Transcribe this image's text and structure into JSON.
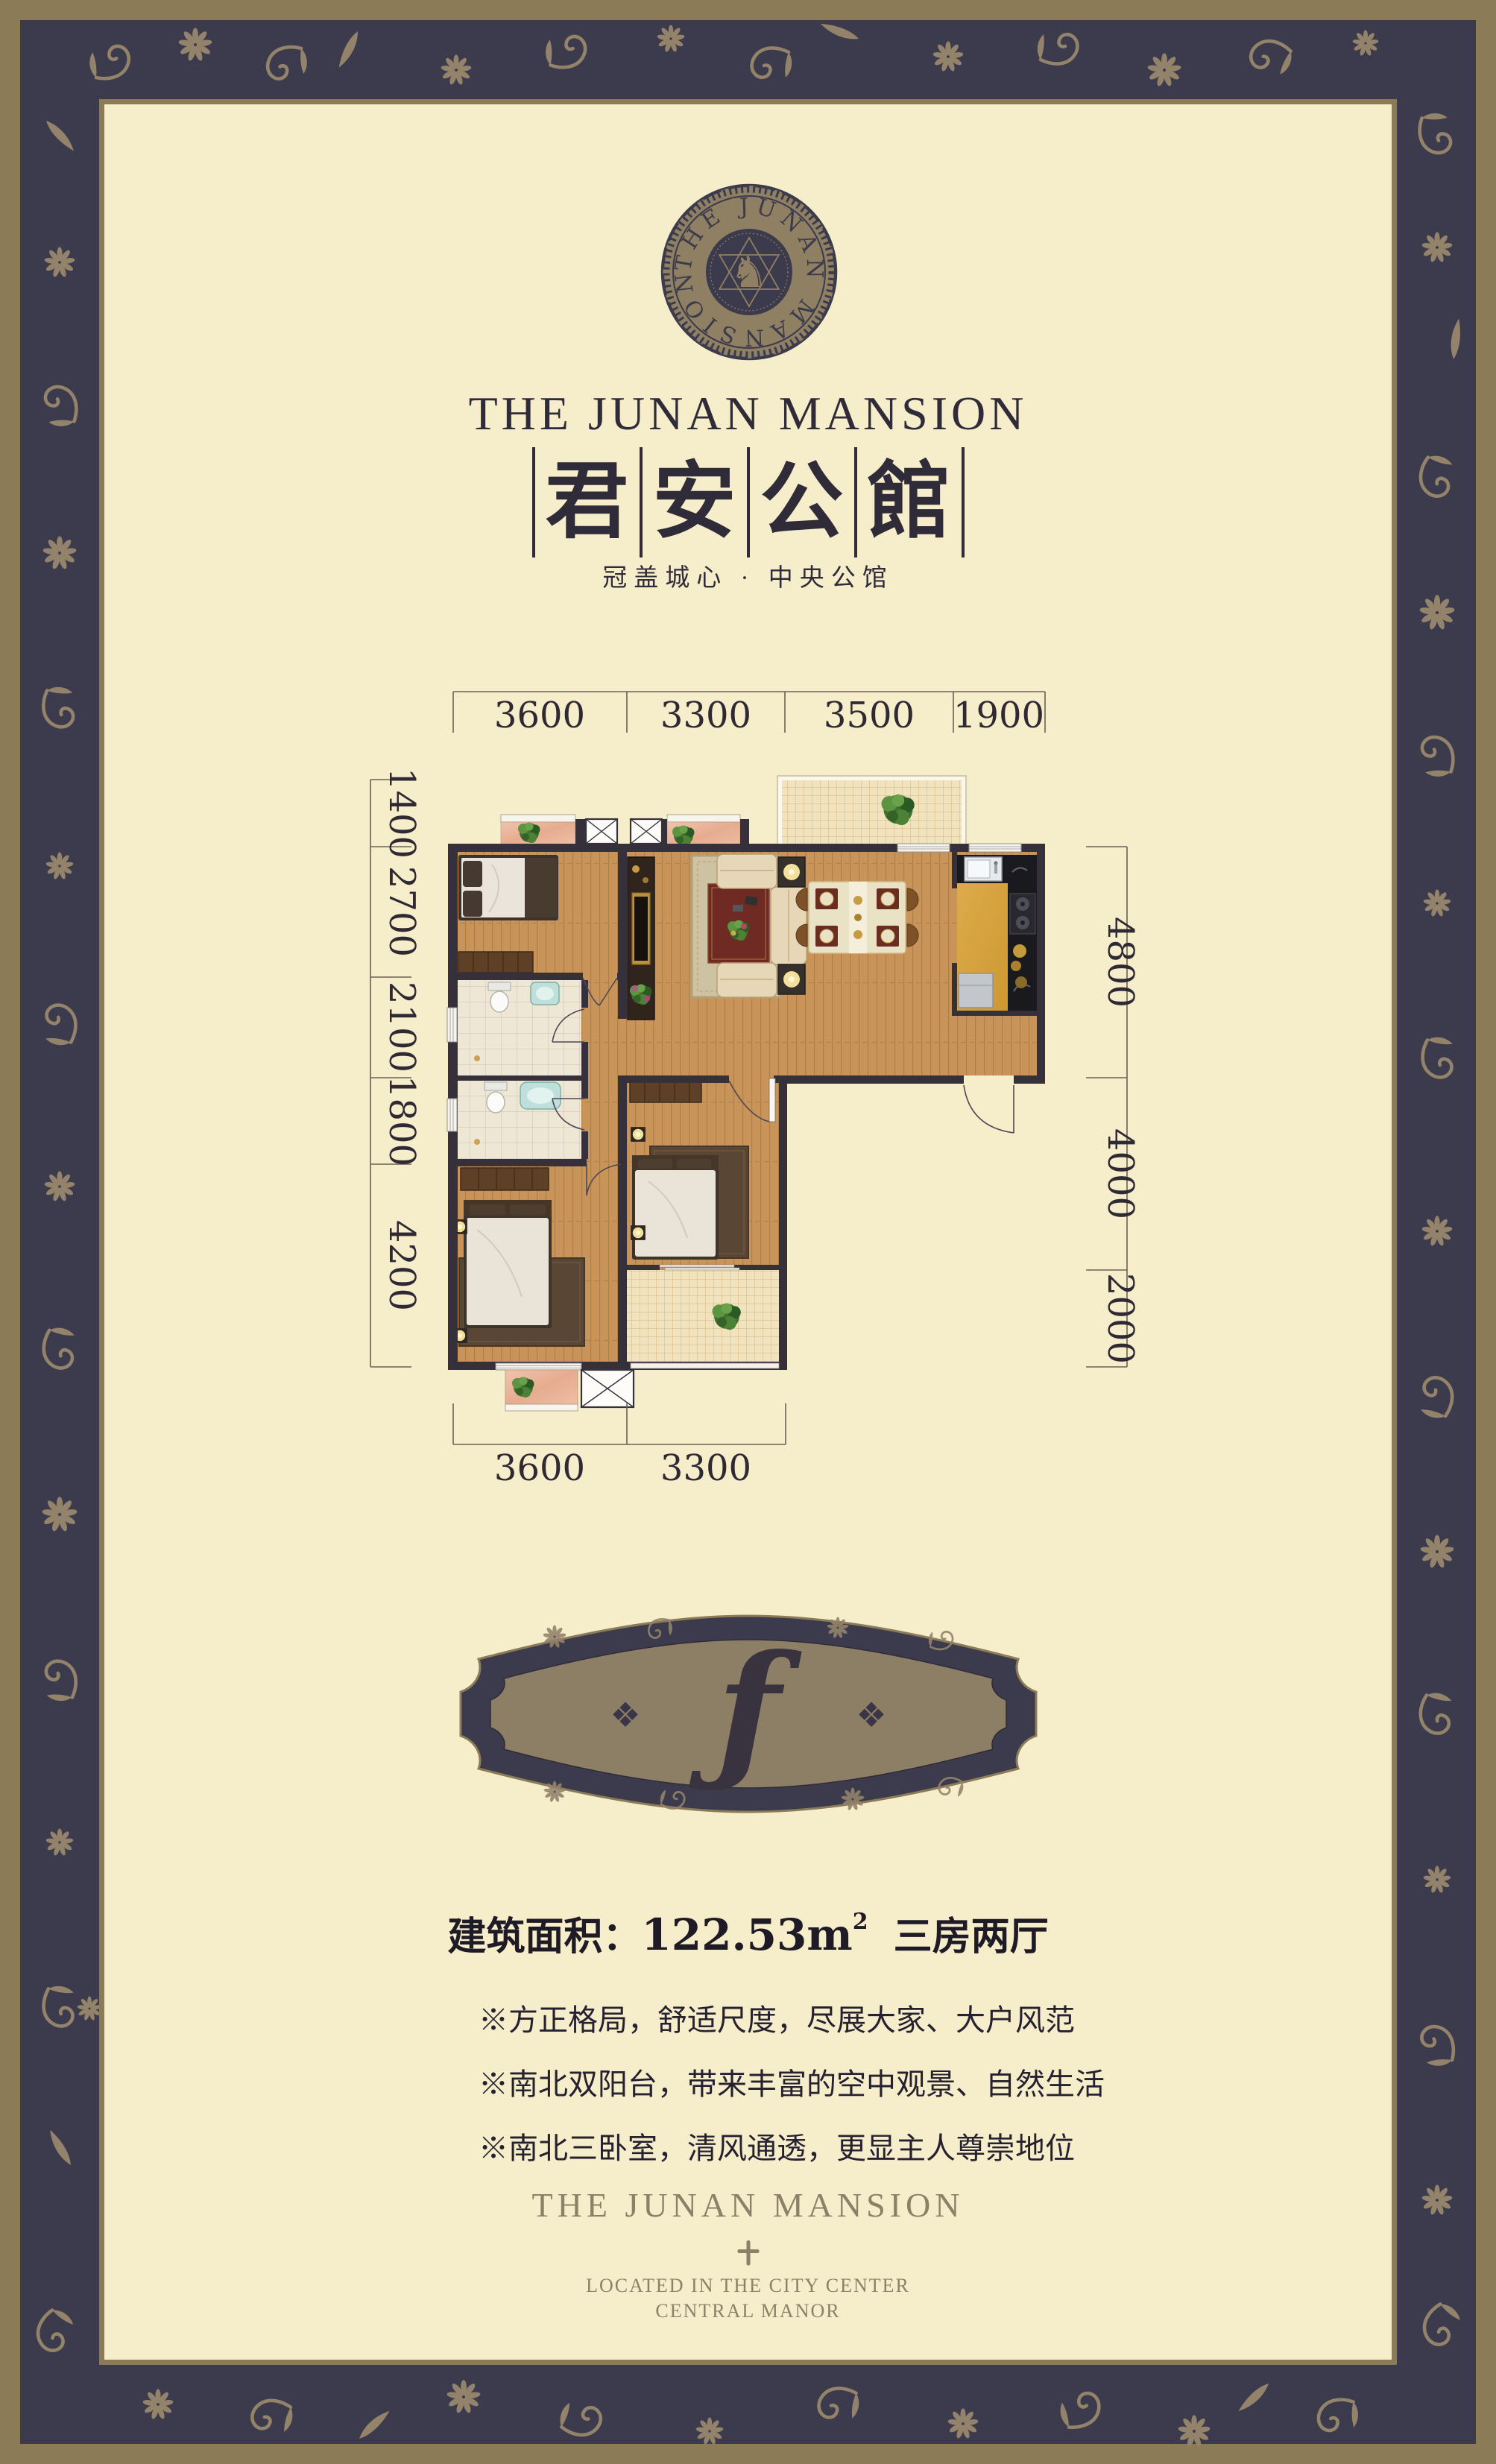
{
  "colors": {
    "frame_tan": "#8c7b57",
    "band_navy": "#3b3b4d",
    "ornament_tan": "#93836a",
    "panel_cream": "#f6edca",
    "wall_dark": "#36303a",
    "wood_floor": "#c89459",
    "accent_gold": "#c59c44"
  },
  "header": {
    "brand": "THE JUNAN MANSION",
    "brand_cn": [
      "君",
      "安",
      "公",
      "館"
    ],
    "tagline_cn": "冠盖城心 · 中央公馆"
  },
  "logo": {
    "ring_text": "THE JUNAN MANSION",
    "horse": "♞"
  },
  "floor_plan": {
    "dims_top": [
      "3600",
      "3300",
      "3500",
      "1900"
    ],
    "dims_left": [
      "1400",
      "2700",
      "2100",
      "1800",
      "4200"
    ],
    "dims_right": [
      "4800",
      "4000",
      "2000"
    ],
    "dims_bottom": [
      "3600",
      "3300"
    ]
  },
  "unit_badge": {
    "letter": "ƒ",
    "ornament": "❖"
  },
  "specs": {
    "area_label": "建筑面积：",
    "area_value": "122.53m",
    "area_unit_sup": "2",
    "rooms": "三房两厅",
    "features": [
      "※方正格局，舒适尺度，尽展大家、大户风范",
      "※南北双阳台，带来丰富的空中观景、自然生活",
      "※南北三卧室，清风通透，更显主人尊崇地位"
    ]
  },
  "footer": {
    "brand": "THE JUNAN MANSION",
    "line1": "LOCATED IN THE CITY CENTER",
    "line2": "CENTRAL MANOR"
  }
}
